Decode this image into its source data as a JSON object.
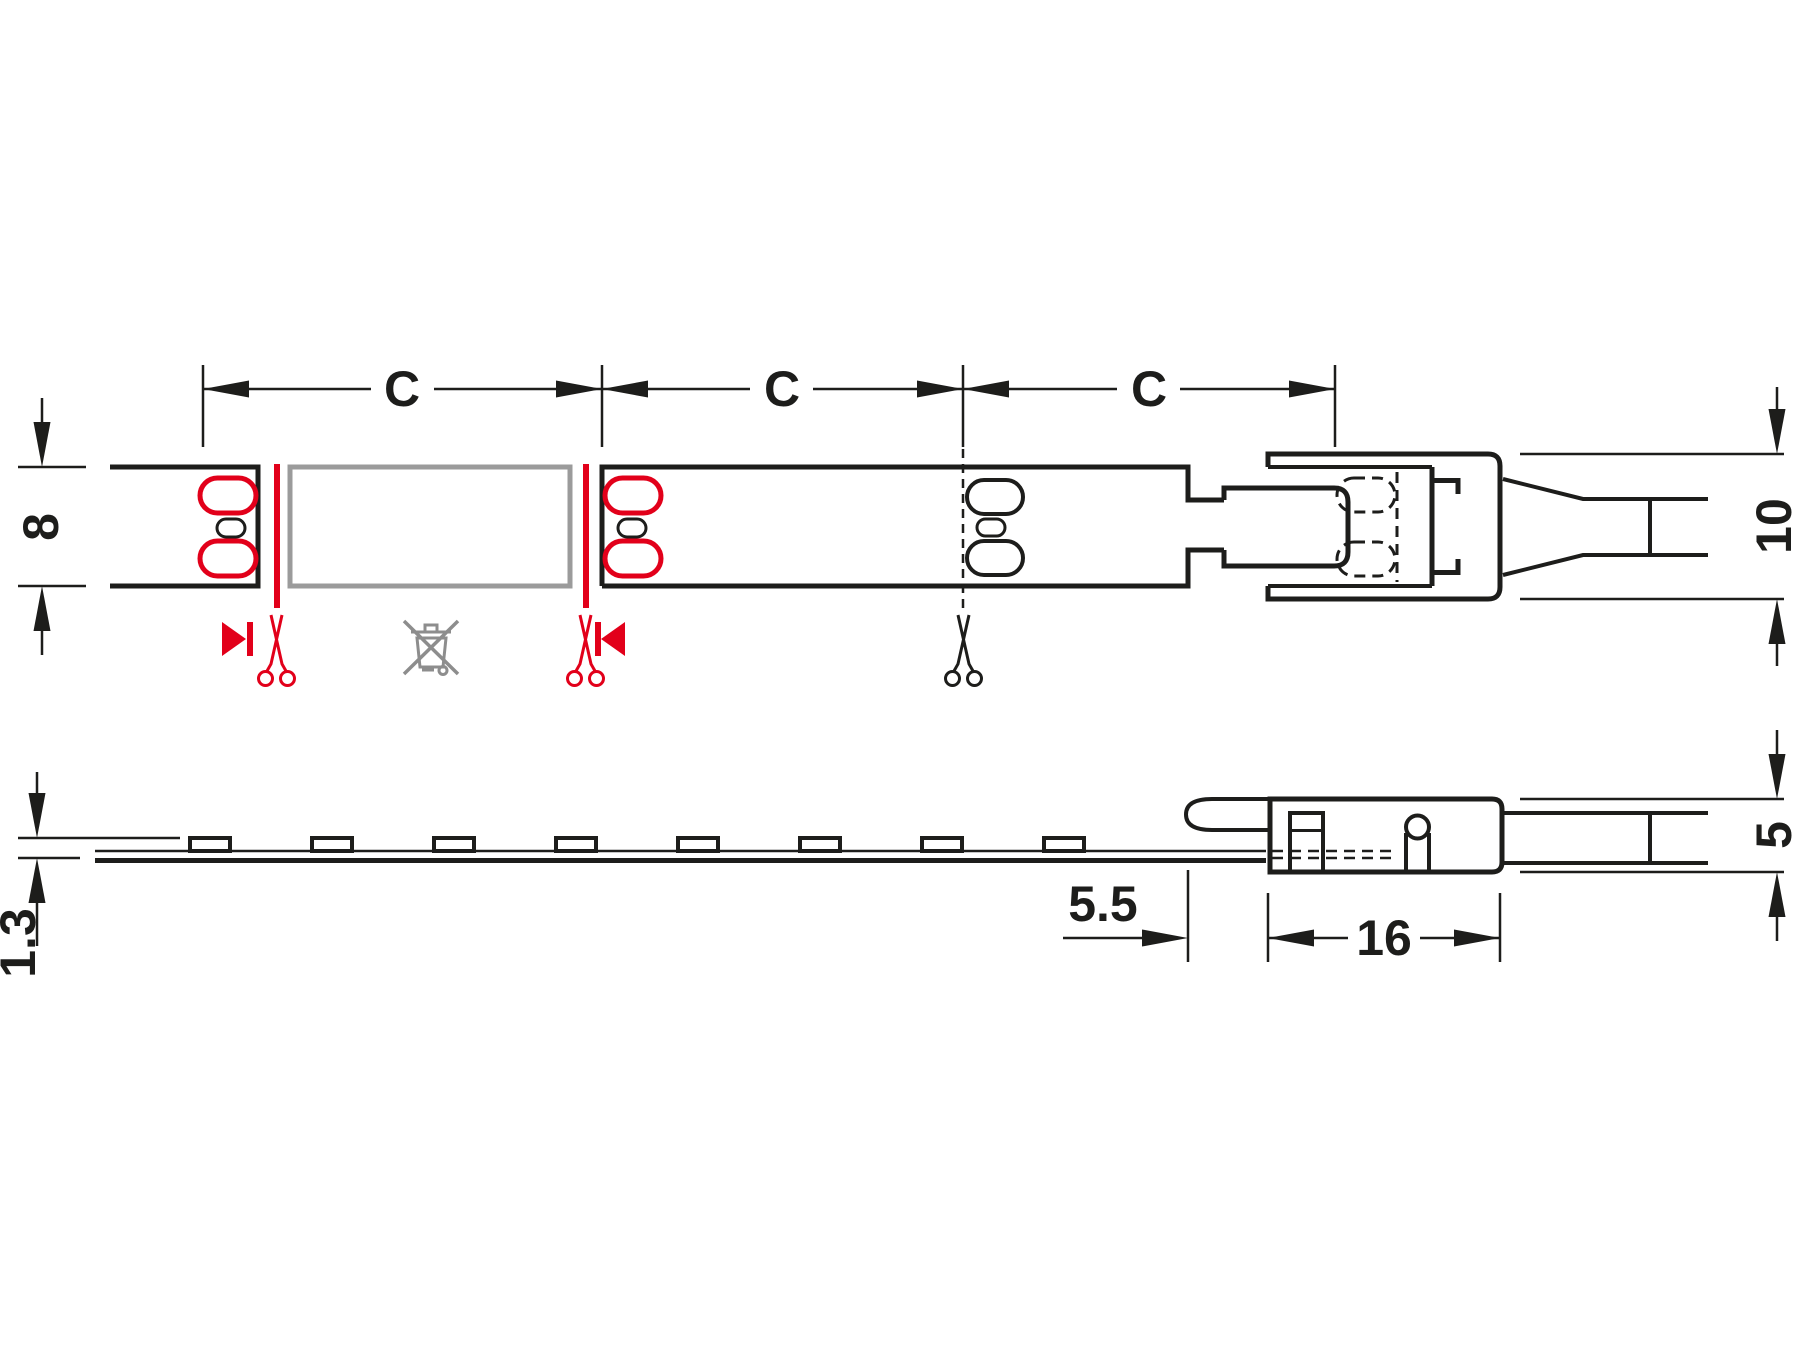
{
  "colors": {
    "line": "#1d1d1b",
    "accent_red": "#e2001a",
    "muted_gray": "#9b9b9b",
    "icon_gray": "#8d8d8d",
    "background": "#ffffff"
  },
  "top_view": {
    "cut_length_labels": [
      "C",
      "C",
      "C"
    ],
    "strip_width_label": "8",
    "connector_width_label": "10"
  },
  "side_view": {
    "strip_height_label": "1.3",
    "connector_inset_label": "5.5",
    "connector_length_label": "16",
    "connector_height_label": "5"
  },
  "icons": {
    "scissors_red": "cut-here-scissors",
    "scissors_black": "optional-cut-scissors",
    "waste_bin": "crossed-out-waste-bin",
    "polarity": "polarity-direction-mark"
  }
}
